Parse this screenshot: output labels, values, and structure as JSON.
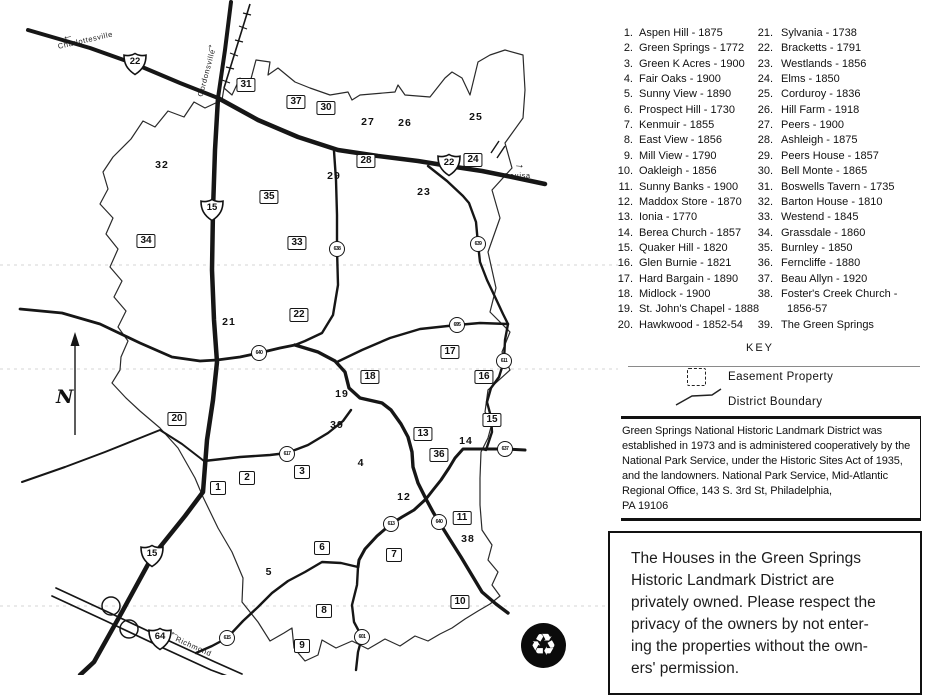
{
  "colors": {
    "ink": "#161616",
    "paper": "#ffffff"
  },
  "map": {
    "north_label": "N",
    "recycle_icon": "♻",
    "place_labels": [
      {
        "name": "charlottesville-label",
        "text": "Charlottesville",
        "x": 58,
        "y": 42,
        "rot": -13
      },
      {
        "name": "gordonsville-label",
        "text": "Gordonsville",
        "x": 200,
        "y": 92,
        "rot": -75
      },
      {
        "name": "louisa-label",
        "text": "Louisa",
        "x": 505,
        "y": 171,
        "rot": 0
      },
      {
        "name": "richmond-label",
        "text": "Richmond",
        "x": 176,
        "y": 634,
        "rot": 24
      }
    ],
    "direction_arrows": [
      {
        "name": "arrow-to-charlottesville",
        "glyph": "←",
        "x": 62,
        "y": 30,
        "rot": -12
      },
      {
        "name": "arrow-to-gordonsville",
        "glyph": "↑",
        "x": 207,
        "y": 42,
        "rot": 8
      },
      {
        "name": "arrow-to-louisa",
        "glyph": "→",
        "x": 514,
        "y": 159,
        "rot": 5
      },
      {
        "name": "arrow-to-richmond",
        "glyph": "←",
        "x": 170,
        "y": 627,
        "rot": 25
      }
    ],
    "boxed_markers": [
      {
        "n": "1",
        "x": 218,
        "y": 488
      },
      {
        "n": "2",
        "x": 247,
        "y": 478
      },
      {
        "n": "3",
        "x": 302,
        "y": 472
      },
      {
        "n": "6",
        "x": 322,
        "y": 548
      },
      {
        "n": "7",
        "x": 394,
        "y": 555
      },
      {
        "n": "8",
        "x": 324,
        "y": 611
      },
      {
        "n": "9",
        "x": 302,
        "y": 646
      },
      {
        "n": "10",
        "x": 460,
        "y": 602
      },
      {
        "n": "11",
        "x": 462,
        "y": 518
      },
      {
        "n": "13",
        "x": 423,
        "y": 434
      },
      {
        "n": "15",
        "x": 492,
        "y": 420
      },
      {
        "n": "16",
        "x": 484,
        "y": 377
      },
      {
        "n": "17",
        "x": 450,
        "y": 352
      },
      {
        "n": "18",
        "x": 370,
        "y": 377
      },
      {
        "n": "20",
        "x": 177,
        "y": 419
      },
      {
        "n": "22",
        "x": 299,
        "y": 315
      },
      {
        "n": "24",
        "x": 473,
        "y": 160
      },
      {
        "n": "28",
        "x": 366,
        "y": 161
      },
      {
        "n": "30",
        "x": 326,
        "y": 108
      },
      {
        "n": "31",
        "x": 246,
        "y": 85
      },
      {
        "n": "33",
        "x": 297,
        "y": 243
      },
      {
        "n": "34",
        "x": 146,
        "y": 241
      },
      {
        "n": "35",
        "x": 269,
        "y": 197
      },
      {
        "n": "36",
        "x": 439,
        "y": 455
      },
      {
        "n": "37",
        "x": 296,
        "y": 102
      }
    ],
    "plain_markers": [
      {
        "n": "4",
        "x": 361,
        "y": 463
      },
      {
        "n": "5",
        "x": 269,
        "y": 572
      },
      {
        "n": "12",
        "x": 404,
        "y": 497
      },
      {
        "n": "14",
        "x": 466,
        "y": 441
      },
      {
        "n": "19",
        "x": 342,
        "y": 394
      },
      {
        "n": "21",
        "x": 229,
        "y": 322
      },
      {
        "n": "23",
        "x": 424,
        "y": 192
      },
      {
        "n": "25",
        "x": 476,
        "y": 117
      },
      {
        "n": "26",
        "x": 405,
        "y": 123
      },
      {
        "n": "27",
        "x": 368,
        "y": 122
      },
      {
        "n": "29",
        "x": 334,
        "y": 176
      },
      {
        "n": "32",
        "x": 162,
        "y": 165
      },
      {
        "n": "38",
        "x": 468,
        "y": 539
      },
      {
        "n": "39",
        "x": 337,
        "y": 425
      }
    ],
    "route_shields": [
      {
        "label": "22",
        "x": 135,
        "y": 64
      },
      {
        "label": "22",
        "x": 449,
        "y": 165
      },
      {
        "label": "15",
        "x": 212,
        "y": 210
      },
      {
        "label": "15",
        "x": 152,
        "y": 556
      },
      {
        "label": "64",
        "x": 160,
        "y": 639
      }
    ],
    "circle_shields": [
      {
        "label": "638",
        "x": 337,
        "y": 249
      },
      {
        "label": "639",
        "x": 478,
        "y": 244
      },
      {
        "label": "695",
        "x": 457,
        "y": 325
      },
      {
        "label": "640",
        "x": 259,
        "y": 353
      },
      {
        "label": "611",
        "x": 504,
        "y": 361
      },
      {
        "label": "637",
        "x": 505,
        "y": 449
      },
      {
        "label": "617",
        "x": 287,
        "y": 454
      },
      {
        "label": "613",
        "x": 391,
        "y": 524
      },
      {
        "label": "640",
        "x": 439,
        "y": 522
      },
      {
        "label": "601",
        "x": 362,
        "y": 637
      },
      {
        "label": "615",
        "x": 227,
        "y": 638
      }
    ]
  },
  "legend": {
    "column1": [
      {
        "num": "1.",
        "label": "Aspen Hill - 1875"
      },
      {
        "num": "2.",
        "label": "Green Springs - 1772"
      },
      {
        "num": "3.",
        "label": "Green K Acres - 1900"
      },
      {
        "num": "4.",
        "label": "Fair Oaks - 1900"
      },
      {
        "num": "5.",
        "label": "Sunny View - 1890"
      },
      {
        "num": "6.",
        "label": "Prospect Hill - 1730"
      },
      {
        "num": "7.",
        "label": "Kenmuir - 1855"
      },
      {
        "num": "8.",
        "label": "East View - 1856"
      },
      {
        "num": "9.",
        "label": "Mill View - 1790"
      },
      {
        "num": "10.",
        "label": "Oakleigh - 1856"
      },
      {
        "num": "11.",
        "label": "Sunny Banks - 1900"
      },
      {
        "num": "12.",
        "label": "Maddox Store - 1870"
      },
      {
        "num": "13.",
        "label": "Ionia - 1770"
      },
      {
        "num": "14.",
        "label": "Berea Church - 1857"
      },
      {
        "num": "15.",
        "label": "Quaker Hill - 1820"
      },
      {
        "num": "16.",
        "label": "Glen Burnie - 1821"
      },
      {
        "num": "17.",
        "label": "Hard Bargain - 1890"
      },
      {
        "num": "18.",
        "label": "Midlock - 1900"
      },
      {
        "num": "19.",
        "label": "St. John's Chapel - 1888"
      },
      {
        "num": "20.",
        "label": "Hawkwood - 1852-54"
      }
    ],
    "column2": [
      {
        "num": "21.",
        "label": "Sylvania - 1738"
      },
      {
        "num": "22.",
        "label": "Bracketts - 1791"
      },
      {
        "num": "23.",
        "label": "Westlands - 1856"
      },
      {
        "num": "24.",
        "label": "Elms - 1850"
      },
      {
        "num": "25.",
        "label": "Corduroy - 1836"
      },
      {
        "num": "26.",
        "label": "Hill Farm - 1918"
      },
      {
        "num": "27.",
        "label": "Peers - 1900"
      },
      {
        "num": "28.",
        "label": "Ashleigh - 1875"
      },
      {
        "num": "29.",
        "label": "Peers House - 1857"
      },
      {
        "num": "30.",
        "label": "Bell Monte - 1865"
      },
      {
        "num": "31.",
        "label": "Boswells Tavern - 1735"
      },
      {
        "num": "32.",
        "label": "Barton House - 1810"
      },
      {
        "num": "33.",
        "label": "Westend - 1845"
      },
      {
        "num": "34.",
        "label": "Grassdale - 1860"
      },
      {
        "num": "35.",
        "label": "Burnley - 1850"
      },
      {
        "num": "36.",
        "label": "Ferncliffe - 1880"
      },
      {
        "num": "37.",
        "label": "Beau Allyn - 1920"
      },
      {
        "num": "38.",
        "label": "Foster's Creek Church -"
      },
      {
        "num": "",
        "label": "1856-57"
      },
      {
        "num": "39.",
        "label": "The Green Springs"
      }
    ]
  },
  "key": {
    "title": "KEY",
    "items": [
      {
        "label": "Easement Property"
      },
      {
        "label": "District Boundary"
      }
    ]
  },
  "district_info": {
    "lines": [
      "Green Springs National Historic Landmark District was",
      "established in 1973 and is administered cooperatively by the",
      "National Park Service, under the Historic Sites Act of 1935,",
      "and the landowners. National Park Service, Mid-Atlantic",
      "Regional Office, 143 S. 3rd St, Philadelphia,",
      "PA 19106"
    ]
  },
  "notice": {
    "lines": [
      "The Houses in the Green Springs",
      "Historic Landmark District are",
      "privately owned. Please respect the",
      "privacy of the owners by not enter-",
      "ing the properties without the own-",
      "ers' permission."
    ]
  }
}
